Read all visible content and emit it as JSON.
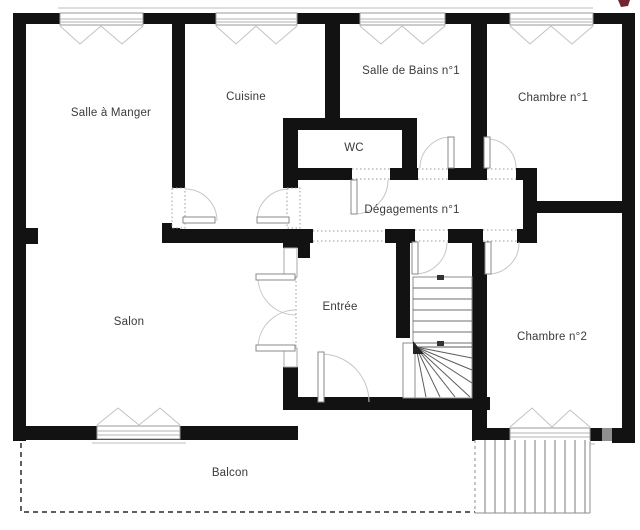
{
  "plan": {
    "title": "apartment-floor-plan",
    "rooms": [
      {
        "name": "Salle à Manger"
      },
      {
        "name": "Cuisine"
      },
      {
        "name": "Salle de Bains n°1"
      },
      {
        "name": "Chambre n°1"
      },
      {
        "name": "WC"
      },
      {
        "name": "Dégagements n°1"
      },
      {
        "name": "Salon"
      },
      {
        "name": "Entrée"
      },
      {
        "name": "Chambre n°2"
      },
      {
        "name": "Balcon"
      }
    ],
    "colors": {
      "wall": "#121212",
      "masked_wall_segment": "#8f8f8f",
      "accent_mark": "#74242e",
      "label_text": "#3a3a3a"
    }
  }
}
